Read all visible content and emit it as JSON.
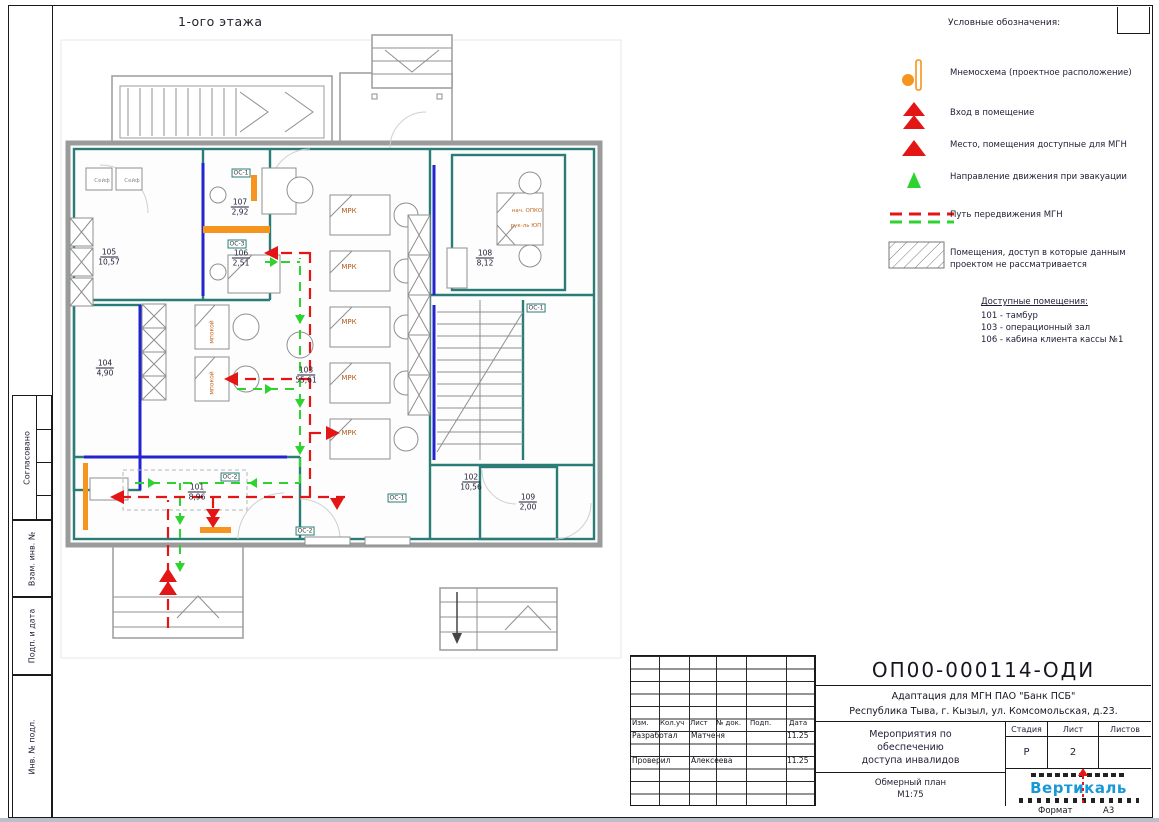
{
  "sheet": {
    "plan_title": "1-ого этажа",
    "format_label": "Формат",
    "format_value": "А3"
  },
  "sidebar": {
    "labels": [
      "Согласовано",
      "Взам. инв. №",
      "Подп. и дата",
      "Инв. № подл."
    ]
  },
  "legend": {
    "title": "Условные обозначения:",
    "items": [
      {
        "icon": "mnemo-icon",
        "label": "Мнемосхема (проектное расположение)",
        "y": 58
      },
      {
        "icon": "entrance-icon",
        "label": "Вход в помещение",
        "y": 98
      },
      {
        "icon": "mgn-place-icon",
        "label": "Место, помещения доступные для МГН",
        "y": 130
      },
      {
        "icon": "evacuation-icon",
        "label": "Направление движения при эвакуации",
        "y": 162
      },
      {
        "icon": "mgn-path-icon",
        "label": "Путь передвижения МГН",
        "y": 200
      },
      {
        "icon": "hatch-icon",
        "label": "Помещения, доступ в которые данным",
        "label2": "проектом не рассматривается",
        "y": 238
      }
    ],
    "accessible_title": "Доступные помещения:",
    "accessible_items": [
      "101 - тамбур",
      "103 - операционный зал",
      "106 - кабина  клиента кассы №1"
    ]
  },
  "plan": {
    "rooms": [
      {
        "num": "105",
        "area": "10,57",
        "x": 109,
        "y": 257
      },
      {
        "num": "107",
        "area": "2,92",
        "x": 240,
        "y": 207
      },
      {
        "num": "106",
        "area": "2,51",
        "x": 241,
        "y": 258
      },
      {
        "num": "104",
        "area": "4,90",
        "x": 105,
        "y": 368
      },
      {
        "num": "103",
        "area": "55,61",
        "x": 306,
        "y": 375
      },
      {
        "num": "108",
        "area": "8,12",
        "x": 485,
        "y": 258
      },
      {
        "num": "102",
        "area": "10,56",
        "x": 471,
        "y": 482
      },
      {
        "num": "109",
        "area": "2,00",
        "x": 528,
        "y": 502
      },
      {
        "num": "101",
        "area": "8,96",
        "x": 197,
        "y": 492
      }
    ],
    "tags": [
      {
        "text": "МРК",
        "x": 349,
        "y": 211,
        "kind": "desk"
      },
      {
        "text": "МРК",
        "x": 349,
        "y": 267,
        "kind": "desk"
      },
      {
        "text": "МРК",
        "x": 349,
        "y": 322,
        "kind": "desk"
      },
      {
        "text": "МРК",
        "x": 349,
        "y": 378,
        "kind": "desk"
      },
      {
        "text": "МРК",
        "x": 349,
        "y": 433,
        "kind": "desk"
      },
      {
        "text": "нач. ОПКО",
        "x": 527,
        "y": 211,
        "kind": "desk-sm"
      },
      {
        "text": "рук-ль ЮП",
        "x": 526,
        "y": 226,
        "kind": "desk-sm"
      },
      {
        "text": "мпокой",
        "x": 212,
        "y": 332,
        "kind": "vert"
      },
      {
        "text": "мпокой",
        "x": 212,
        "y": 383,
        "kind": "vert"
      },
      {
        "text": "Сейф",
        "x": 102,
        "y": 181,
        "kind": "gray"
      },
      {
        "text": "Сейф",
        "x": 132,
        "y": 181,
        "kind": "gray"
      },
      {
        "text": "ОС-1",
        "x": 241,
        "y": 173,
        "kind": "os"
      },
      {
        "text": "ОС-3",
        "x": 237,
        "y": 244,
        "kind": "os"
      },
      {
        "text": "ОС-2",
        "x": 230,
        "y": 477,
        "kind": "os"
      },
      {
        "text": "ОС-1",
        "x": 536,
        "y": 308,
        "kind": "os"
      },
      {
        "text": "ОС-1",
        "x": 397,
        "y": 498,
        "kind": "os"
      },
      {
        "text": "ОС-2",
        "x": 305,
        "y": 531,
        "kind": "os"
      }
    ]
  },
  "titleblock": {
    "doc_number": "ОП00-000114-ОДИ",
    "object_line1": "Адаптация для МГН ПАО \"Банк ПСБ\"",
    "object_line2": "Республика Тыва, г. Кызыл, ул. Комсомольская, д.23.",
    "header_cols": [
      "Изм.",
      "Кол.уч",
      "Лист",
      "№ док.",
      "Подп.",
      "Дата"
    ],
    "rows": [
      {
        "role": "Разработал",
        "name": "Матченя",
        "date": "11.25"
      },
      {
        "role": "Проверил",
        "name": "Алексеева",
        "date": "11.25"
      }
    ],
    "task_line1": "Мероприятия по",
    "task_line2": "обеспечению",
    "task_line3": "доступа инвалидов",
    "doc_type": "Обмерный план",
    "scale": "М1:75",
    "stage_label": "Стадия",
    "sheet_label": "Лист",
    "sheets_label": "Листов",
    "stage_value": "Р",
    "sheet_value": "2",
    "logo_name": "Вертикаль"
  }
}
